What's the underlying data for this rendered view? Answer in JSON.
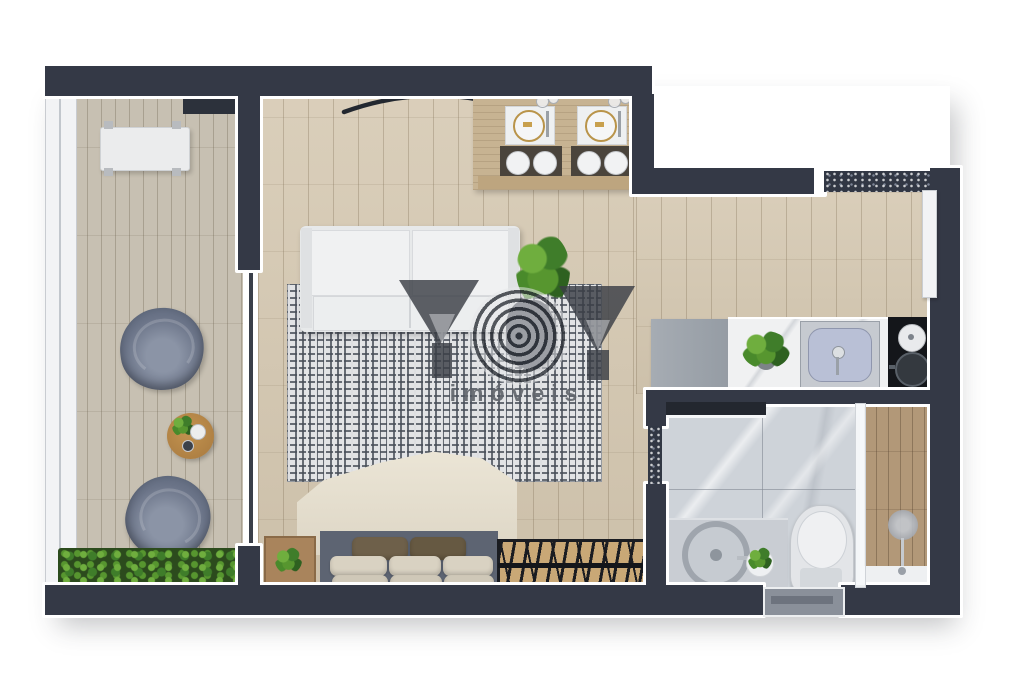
{
  "image_type": "3D rendered top-view floor plan of a studio apartment",
  "watermark": {
    "brand_text": "imóveis",
    "logo": "YOY monogram (two Y triangles with striped O)",
    "logo_color": "#3a3e46",
    "text_color": "#62666c"
  },
  "palette": {
    "wall": "#343946",
    "wall_trim": "#ffffff",
    "wood_living": "#d5c8b1",
    "wood_balcony": "#c7c0b2",
    "marble_bathroom": "#ced3d9",
    "shower_wood": "#b29878",
    "rug_pattern": "#4a505a",
    "plant_green": "#57962f",
    "sofa_white": "#ebedee",
    "duvet_taupe": "#a79e91",
    "armchair_blue_gray": "#6b7488",
    "cooktop_black": "#14161a",
    "sink_basin_blue": "#b9c0d6"
  },
  "rooms": {
    "balcony": {
      "furniture": [
        "bench-table",
        "floor-mat",
        "armchair",
        "armchair",
        "coffee-table",
        "planter-bed",
        "glass-railing",
        "sliding-glass-door"
      ]
    },
    "living_bedroom": {
      "furniture": [
        "curtain-arc",
        "dining-counter",
        "place-setting",
        "place-setting",
        "stools",
        "sofa",
        "potted-plant",
        "greek-key-rug",
        "double-bed",
        "pillows",
        "nightstand",
        "clothes-rack"
      ]
    },
    "kitchen": {
      "furniture": [
        "refrigerator",
        "marble-counter",
        "counter-plant",
        "sink",
        "cooktop",
        "entrance-doormat",
        "entry-door"
      ]
    },
    "bathroom": {
      "furniture": [
        "bathroom-door",
        "vanity",
        "vessel-sink",
        "vanity-plant",
        "toilet",
        "glass-partition",
        "shower-head",
        "bathroom-window"
      ]
    }
  }
}
